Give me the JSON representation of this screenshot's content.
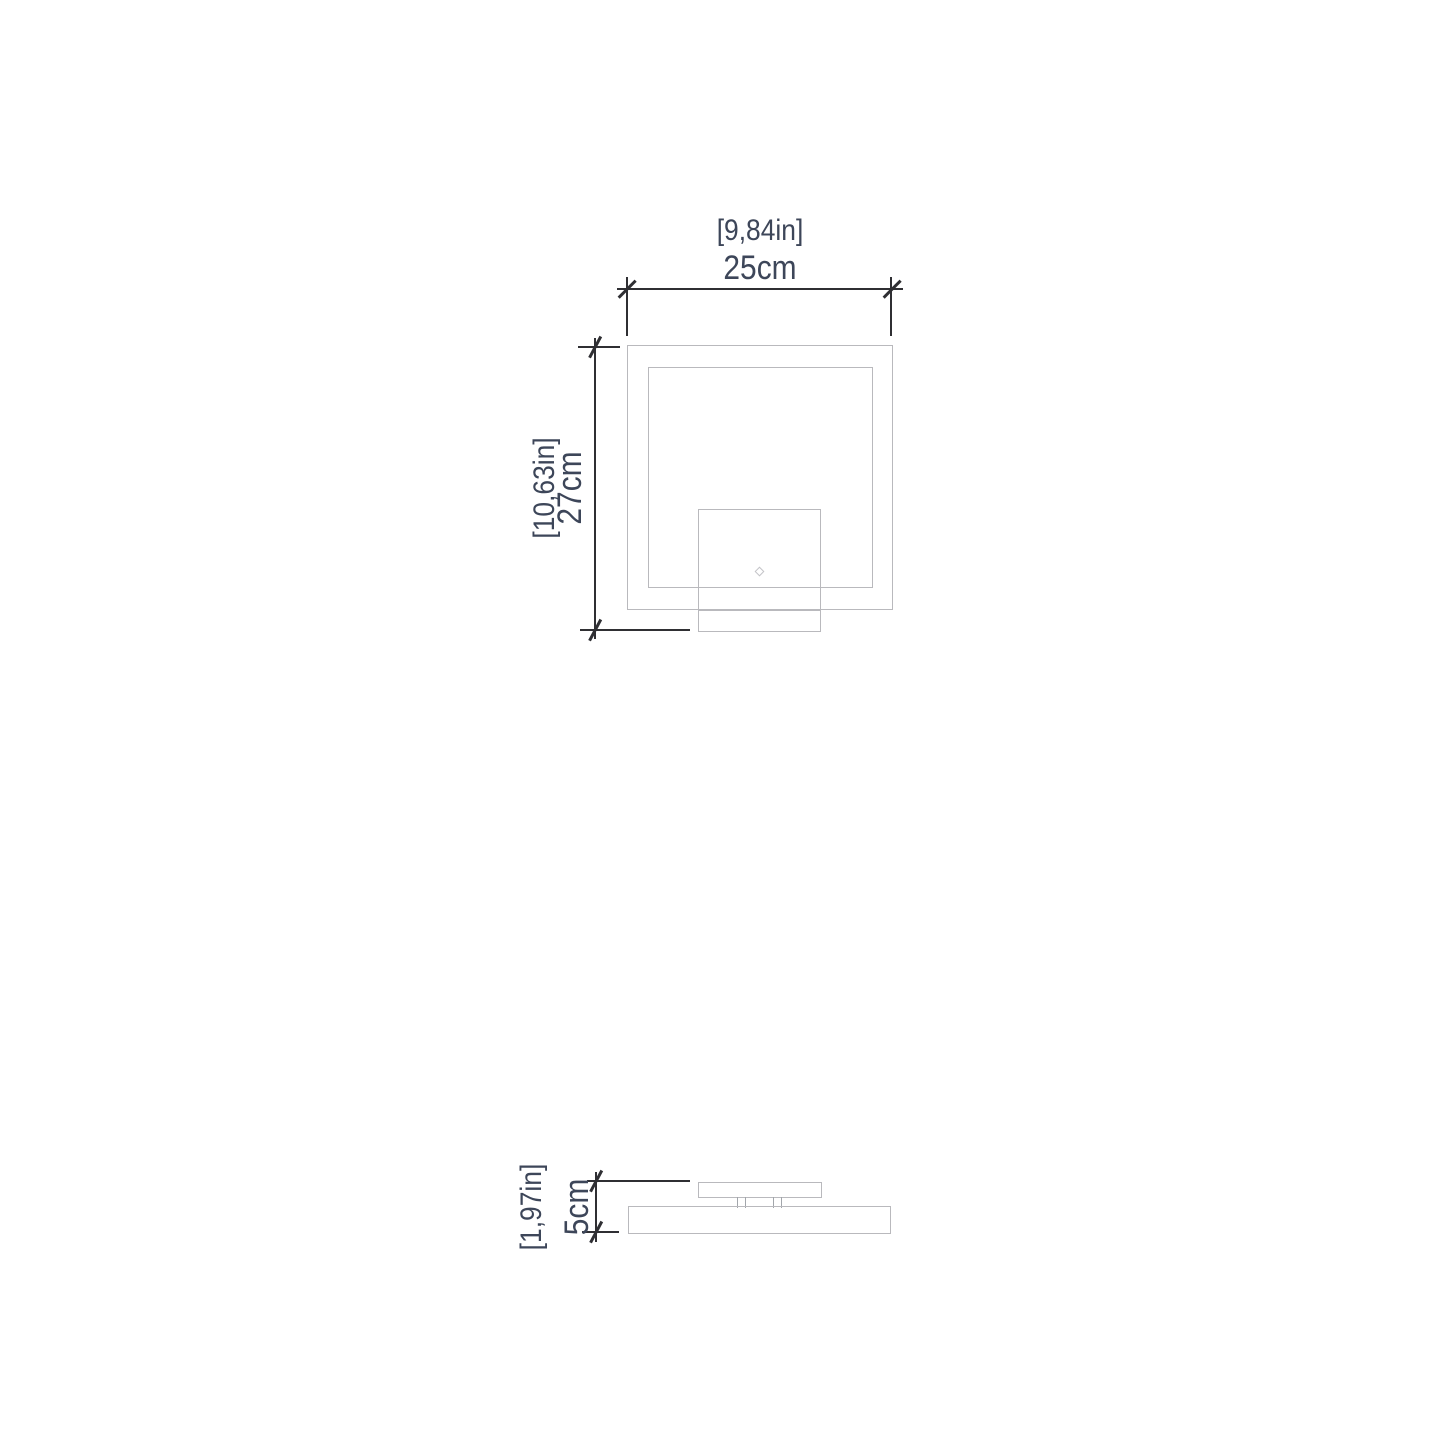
{
  "drawing": {
    "colors": {
      "dimension_line": "#2f2f33",
      "object_outline": "#b9b9bd",
      "label_text": "#3d4659"
    },
    "top_view": {
      "width_dimension": {
        "inches_label": "[9,84in]",
        "cm_label": "25cm"
      },
      "height_dimension": {
        "inches_label": "[10,63in]",
        "cm_label": "27cm"
      },
      "touch_indicator_icon": "diamond-icon"
    },
    "side_view": {
      "height_dimension": {
        "inches_label": "[1,97in]",
        "cm_label": "5cm"
      }
    }
  }
}
